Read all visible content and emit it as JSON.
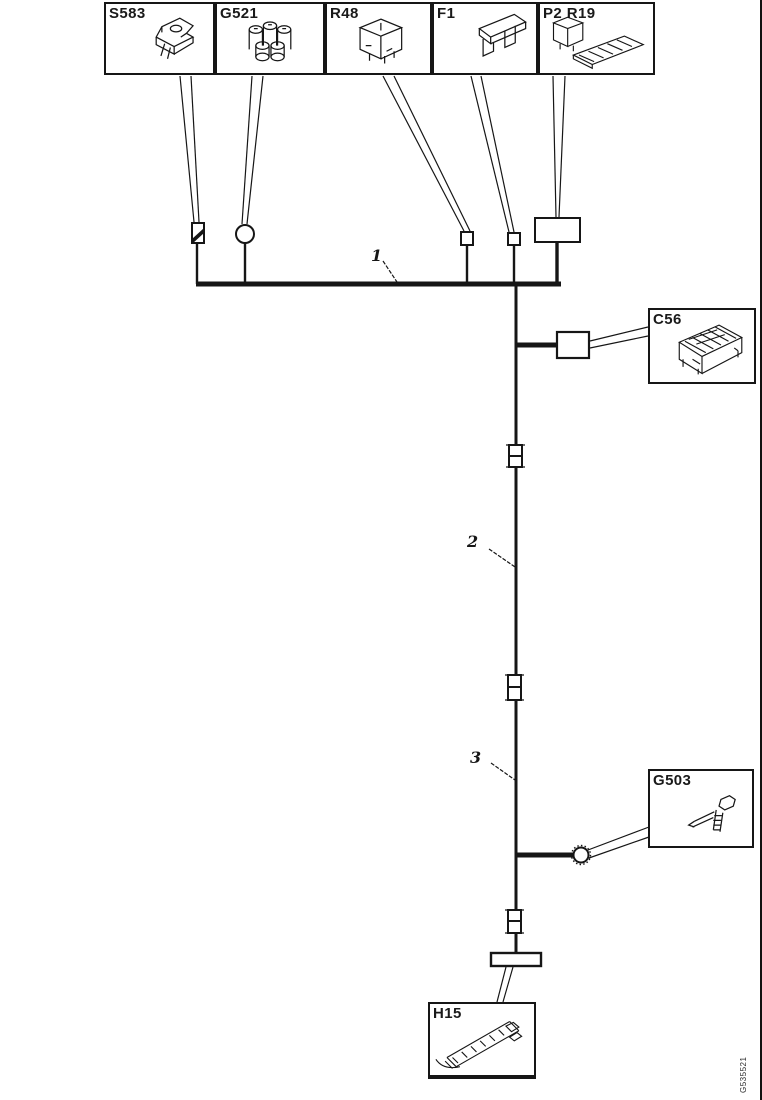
{
  "page": {
    "background": "#ffffff",
    "line_color": "#161616"
  },
  "boxes": {
    "s583": {
      "label": "S583"
    },
    "g521": {
      "label": "G521"
    },
    "r48": {
      "label": "R48"
    },
    "f1": {
      "label": "F1"
    },
    "p2r19": {
      "label": "P2 R19"
    },
    "c56": {
      "label": "C56"
    },
    "g503": {
      "label": "G503"
    },
    "h15": {
      "label": "H15"
    }
  },
  "segments": {
    "seg1": "1",
    "seg2": "2",
    "seg3": "3"
  },
  "footer": {
    "drawing_id": "G535521"
  }
}
